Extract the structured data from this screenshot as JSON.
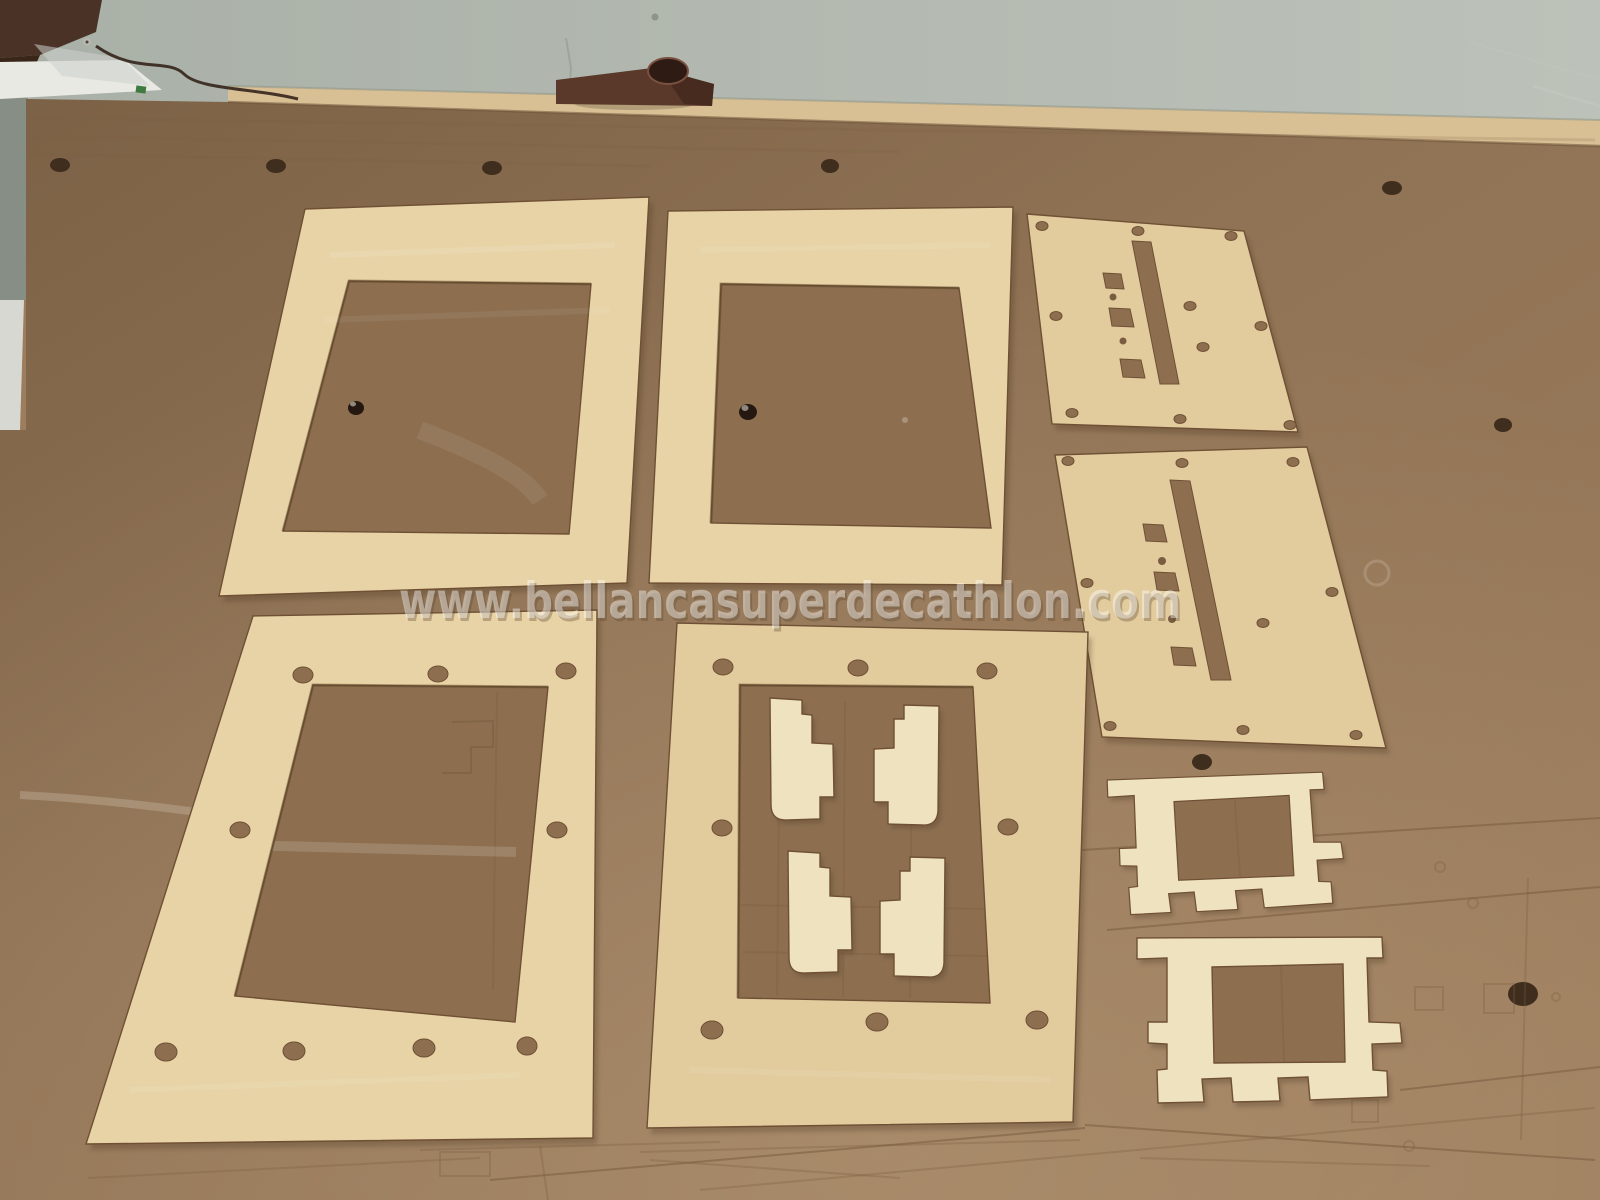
{
  "watermark": {
    "text": "www.bellancasuperdecathlon.com"
  },
  "palette": {
    "wall": "#b2b8af",
    "wall_dark": "#99a096",
    "table_edge": "#d9c094",
    "mdf": "#9c7d5d",
    "mdf_dark": "#8d6f50",
    "mdf_deep": "#7a5d40",
    "mdf_hole": "#3f2d1d",
    "plywood": "#e7d3a6",
    "plywood2": "#e2cc9e",
    "plywood_light": "#efe3bf",
    "kerf": "#6f5034",
    "part_shadow": "#4e3822",
    "block": "#5b392a",
    "block_hole": "#2e1b13",
    "machine_wood": "#4b3226",
    "trim_white": "#e9e9e3",
    "acrylic": "#ccd2cc",
    "wire": "#33231a",
    "scratch": "#f0ebe0",
    "watermark_fill": "#ffffff",
    "watermark_edge": "#5f4a33"
  },
  "inventory": {
    "window_frames": 2,
    "slotted_panels": 2,
    "bolt_hole_frames": 2,
    "step_brackets": 4,
    "ladder_formers": 2,
    "spoilboard_screws": 2
  }
}
